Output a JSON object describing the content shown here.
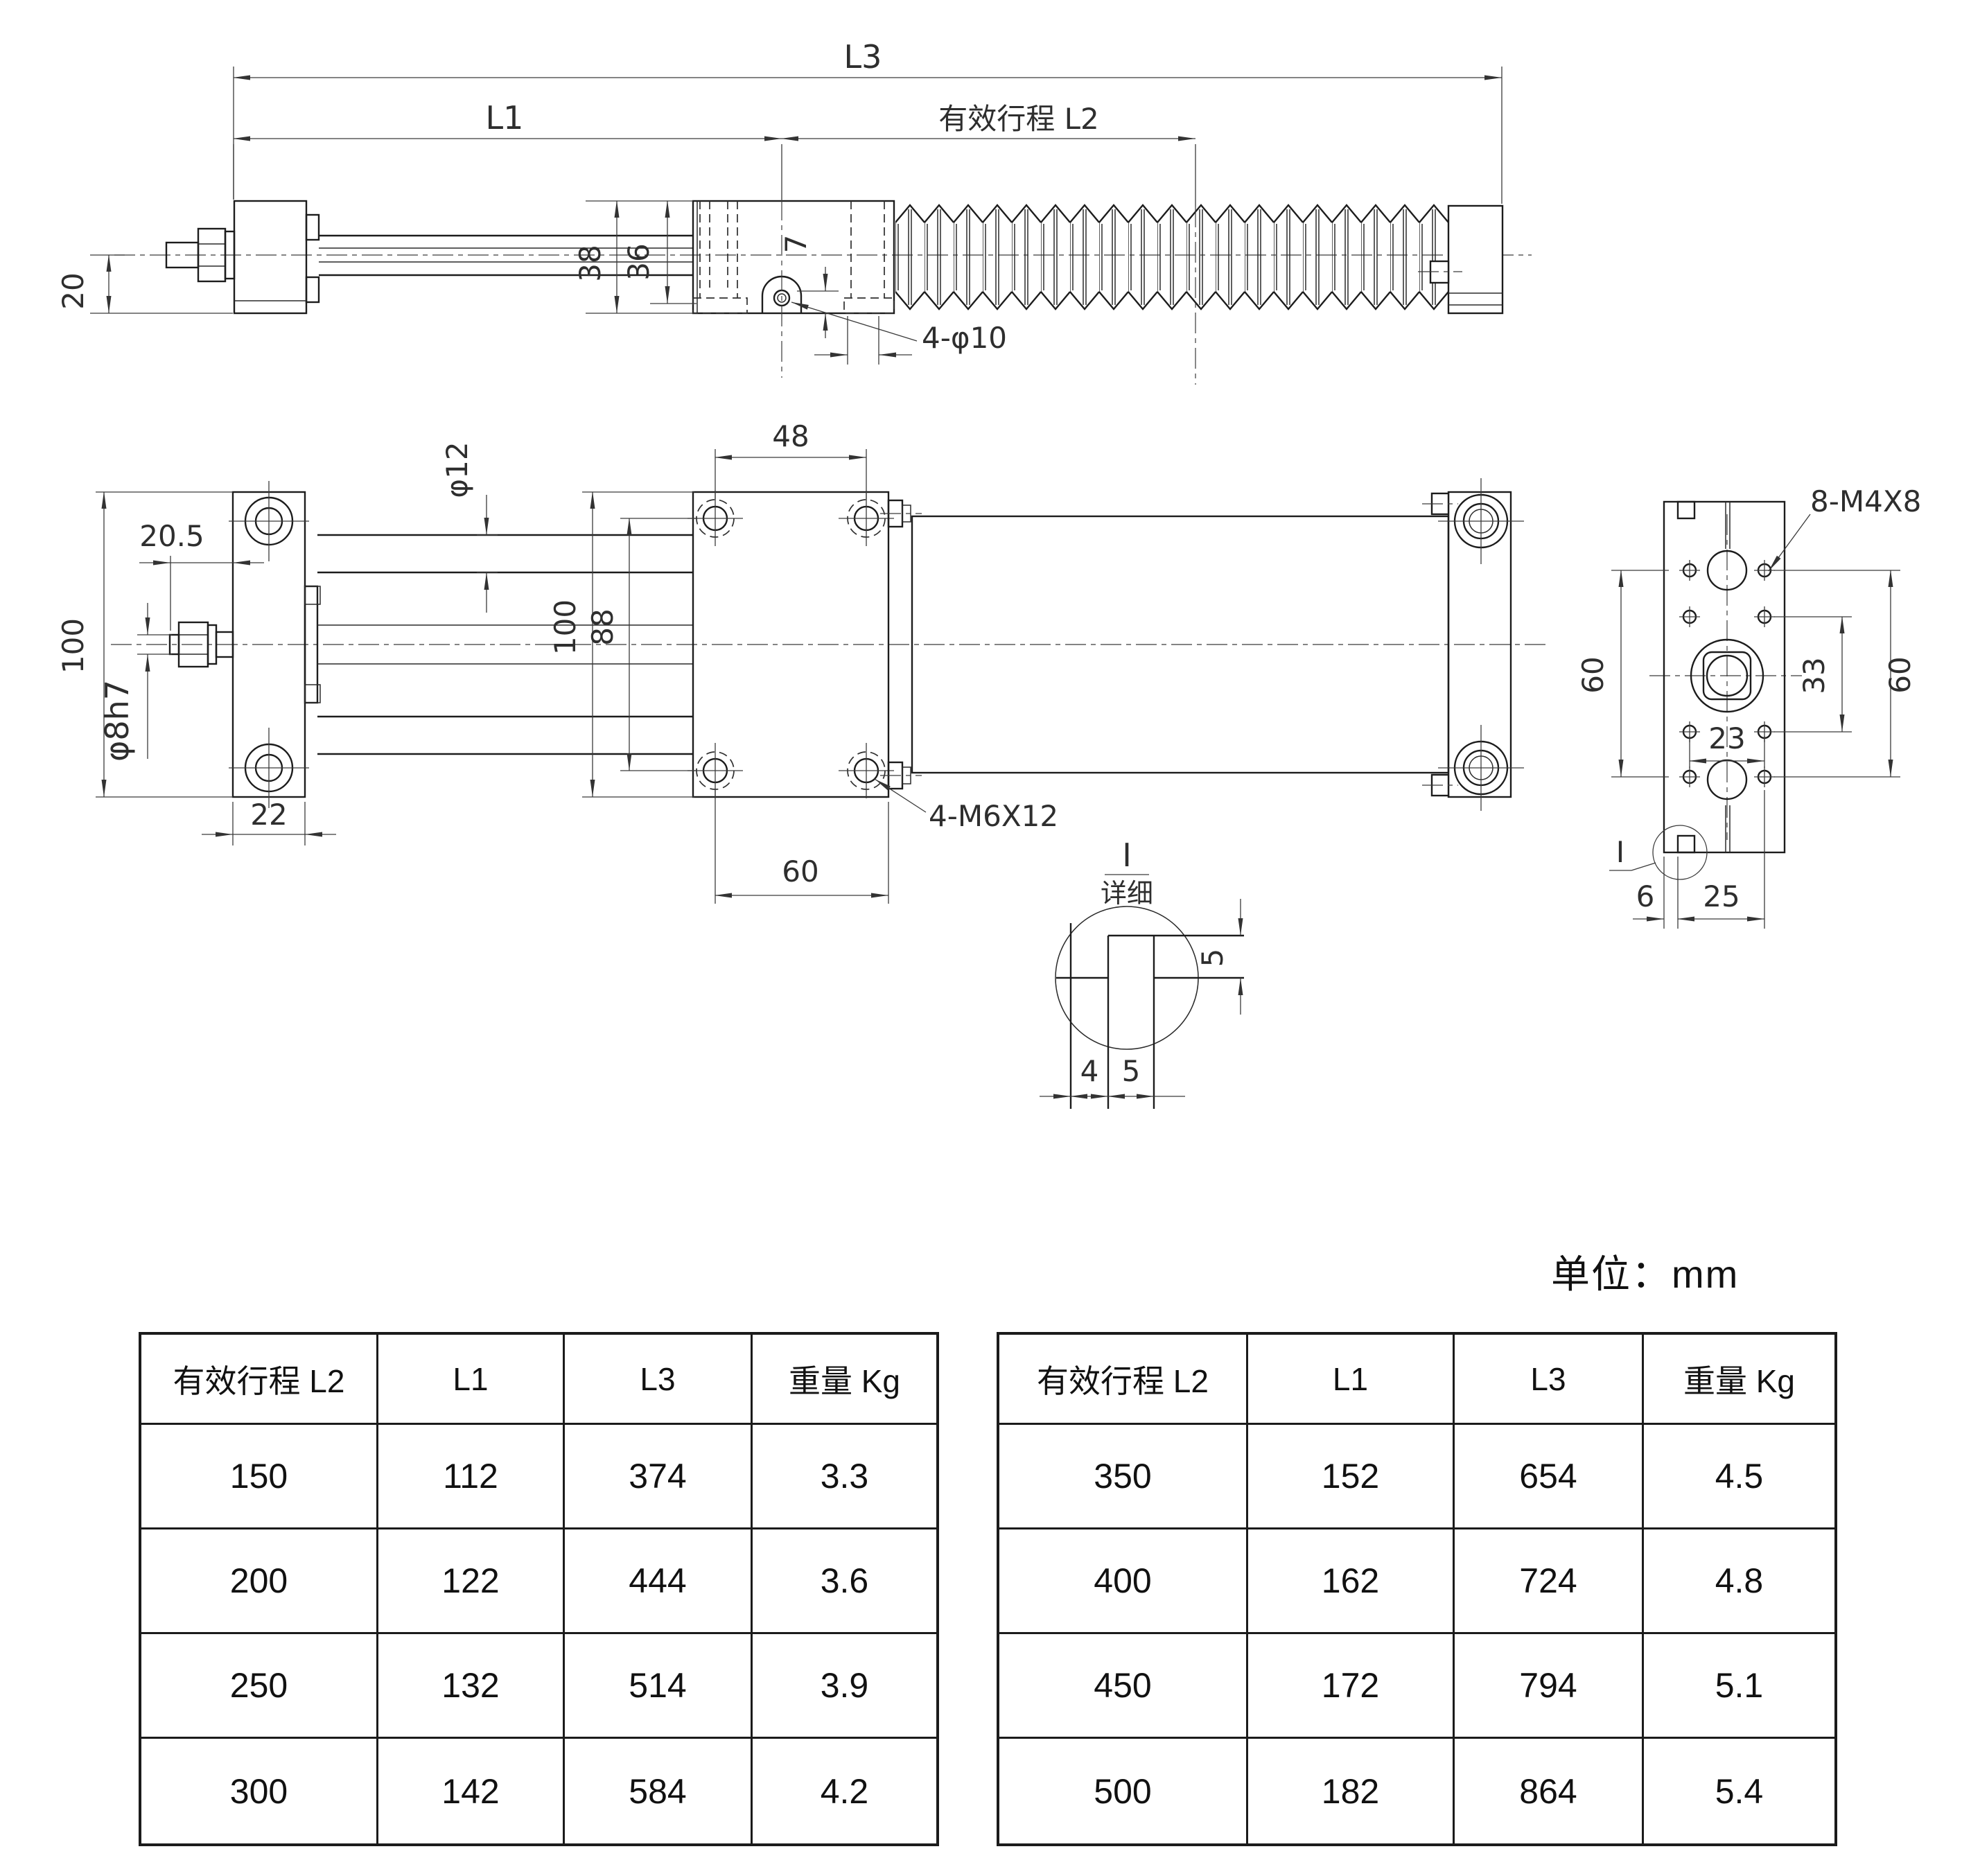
{
  "unit_note": "单位：mm",
  "side_view": {
    "l3": "L3",
    "l1": "L1",
    "stroke_l2": "有效行程 L2",
    "h20": "20",
    "h38": "38",
    "h36": "36",
    "d7": "7",
    "lug_holes": "4-φ10"
  },
  "plan_view": {
    "h100_plate": "100",
    "w20_5": "20.5",
    "rod_tip": "φ8h7",
    "w22": "22",
    "rod_dia": "φ12",
    "w48": "48",
    "h100_body": "100",
    "h88": "88",
    "w60": "60",
    "screws": "4-M6X12"
  },
  "end_view": {
    "screws": "8-M4X8",
    "h60_left": "60",
    "h33": "33",
    "h60_right": "60",
    "w23": "23",
    "w6": "6",
    "w25": "25",
    "detail_ref": "I"
  },
  "detail_view": {
    "ref": "I",
    "label": "详细",
    "h5": "5",
    "w4": "4",
    "w5": "5"
  },
  "tables": {
    "headers": [
      "有效行程 L2",
      "L1",
      "L3",
      "重量 Kg"
    ],
    "left_rows": [
      [
        "150",
        "112",
        "374",
        "3.3"
      ],
      [
        "200",
        "122",
        "444",
        "3.6"
      ],
      [
        "250",
        "132",
        "514",
        "3.9"
      ],
      [
        "300",
        "142",
        "584",
        "4.2"
      ]
    ],
    "right_rows": [
      [
        "350",
        "152",
        "654",
        "4.5"
      ],
      [
        "400",
        "162",
        "724",
        "4.8"
      ],
      [
        "450",
        "172",
        "794",
        "5.1"
      ],
      [
        "500",
        "182",
        "864",
        "5.4"
      ]
    ]
  }
}
